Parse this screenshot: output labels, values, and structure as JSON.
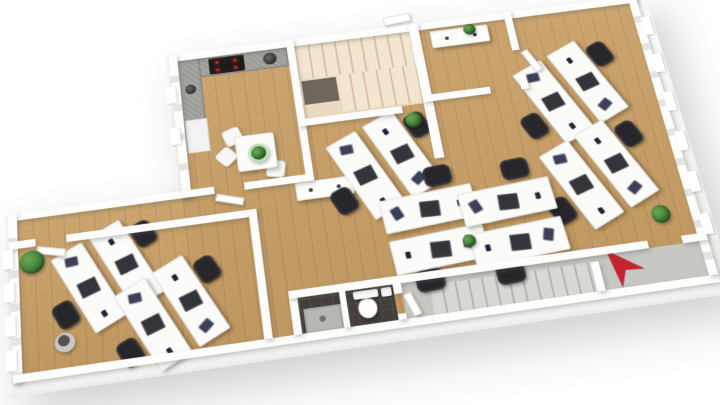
{
  "scene": {
    "type": "3d-floor-plan-render",
    "subject": "office-floor",
    "view": "tilted-top-down",
    "background": "#ffffff"
  },
  "palette": {
    "wall": "#fdfdfc",
    "wall-shadow": "rgba(90,90,90,0.35)",
    "window-gap": "#e4e4e0",
    "wood": "#c99f66",
    "stair-beige": "#ecd9c1",
    "stair-tread": "#f3e6d1",
    "stair-line": "#d8c2a3",
    "corridor": "#c7c7c4",
    "corridor-tread": "#d8d8d5",
    "corridor-line": "#b6b6b3",
    "bath-dark": "#453f3b",
    "counter": "#9d9d9a",
    "cooktop": "#1c1c1c",
    "burner": "#c23434",
    "desk": "#fbfbfa",
    "desk-edge": "#e4e4e1",
    "chair": "#27272b",
    "monitor": "#34343b",
    "laptop": "#3b3f58",
    "pot-mint": "#bfe0bb",
    "arrow-red": "#c5232e"
  },
  "rooms": [
    {
      "name": "kitchen",
      "floor": "wood"
    },
    {
      "name": "upper-stairwell",
      "floor": "stair-beige"
    },
    {
      "name": "meeting-room",
      "floor": "wood"
    },
    {
      "name": "open-office",
      "floor": "wood"
    },
    {
      "name": "team-office-left",
      "floor": "wood"
    },
    {
      "name": "hallway",
      "floor": "wood"
    },
    {
      "name": "bathroom",
      "floor": "bath-dark"
    },
    {
      "name": "entrance-corridor-stairs",
      "floor": "corridor"
    }
  ],
  "furniture_inventory": {
    "desk_clusters": 7,
    "desks": 14,
    "office_chairs": 14,
    "monitors": 14,
    "laptops": 14,
    "kitchen_table": 1,
    "kitchen_chairs": 3,
    "sideboards": 2,
    "plants": 6,
    "waste_bin": 1,
    "toilet": 1,
    "shower": 1,
    "cooktop_burners": 4,
    "staircases": 2
  },
  "desk_clusters": [
    {
      "id": "A",
      "x": 578,
      "y": 104,
      "rot": -24,
      "layout": "vertical"
    },
    {
      "id": "B",
      "x": 585,
      "y": 200,
      "rot": -24,
      "layout": "vertical"
    },
    {
      "id": "C",
      "x": 374,
      "y": 158,
      "rot": -24,
      "layout": "vertical"
    },
    {
      "id": "D1",
      "x": 412,
      "y": 234,
      "rot": -4,
      "layout": "horizontal"
    },
    {
      "id": "D2",
      "x": 490,
      "y": 238,
      "rot": -4,
      "layout": "horizontal"
    },
    {
      "id": "E",
      "x": 92,
      "y": 236,
      "rot": -26,
      "layout": "vertical",
      "scale": 0.95
    },
    {
      "id": "F",
      "x": 150,
      "y": 282,
      "rot": -26,
      "layout": "vertical",
      "scale": 0.95
    }
  ],
  "plants": [
    {
      "id": "office-corner-plant",
      "x": 22,
      "y": 212,
      "size": 24
    },
    {
      "id": "stair-landing-plant",
      "x": 413,
      "y": 113,
      "size": 17
    },
    {
      "id": "meeting-sideboard-plant",
      "x": 490,
      "y": 15,
      "size": 13
    },
    {
      "id": "office-right-plant",
      "x": 636,
      "y": 252,
      "size": 19
    },
    {
      "id": "desk-row-plant",
      "x": 444,
      "y": 252,
      "size": 13
    },
    {
      "id": "kitchen-table-plant",
      "x": 249,
      "y": 124,
      "size": 15,
      "pot": "mint"
    }
  ],
  "window_bays": {
    "right_wall": 6,
    "left_wall": 4,
    "kitchen_wall": 2
  },
  "compass": {
    "type": "north-arrow",
    "color_ref": "arrow-red",
    "heading": "up-left"
  }
}
